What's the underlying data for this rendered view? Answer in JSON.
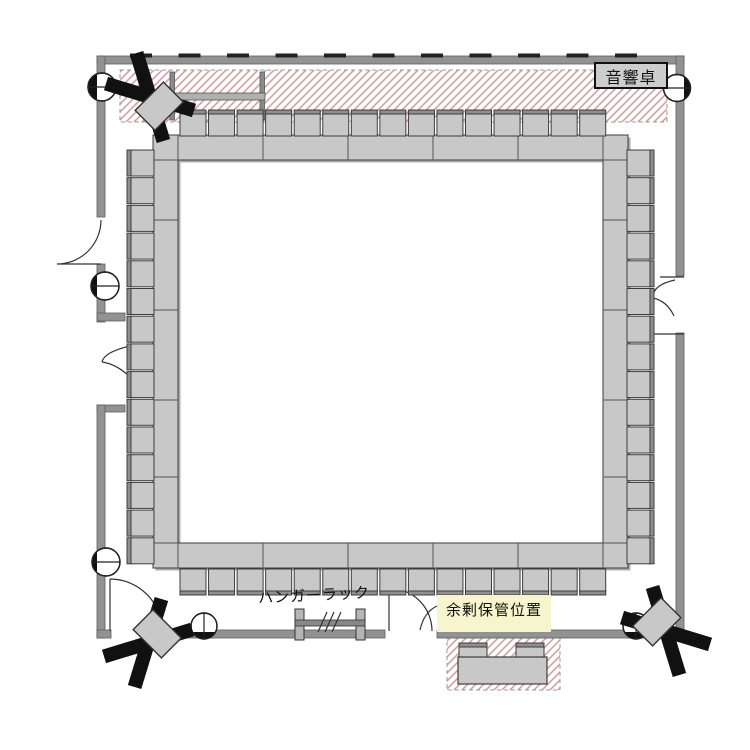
{
  "labels": {
    "sound_console": "音響卓",
    "hanger_rack": "ハンガーラック",
    "surplus_storage": "余剰保管位置"
  },
  "colors": {
    "background": "#ffffff",
    "wall": "#929292",
    "wall_edge": "#5e5e5e",
    "wall_tick": "#222222",
    "furniture_fill": "#c8c8c8",
    "furniture_edge": "#3c3c3c",
    "chair_back": "#8f8f8f",
    "shadow": "#adadad",
    "hatch_line": "#d2a2a2",
    "hatch_border": "#999999",
    "highlight_yellow": "#f7f5cd",
    "console_box": "#cdcdcd",
    "black": "#111111",
    "door_line": "#333333"
  },
  "layout": {
    "seating": {
      "arrangement": "closed-square",
      "tables_per_side": 5,
      "chairs_top": 15,
      "chairs_bottom": 15,
      "chairs_left": 15,
      "chairs_right": 15,
      "total_chairs": 60
    },
    "storage_area": {
      "tables": 1,
      "chairs": 2
    },
    "equipment": {
      "speakers": 3,
      "wall_columns": 6,
      "doors": 4,
      "hanger_rack": 1,
      "sound_console_desk": 1,
      "partition_rail": 1
    }
  }
}
